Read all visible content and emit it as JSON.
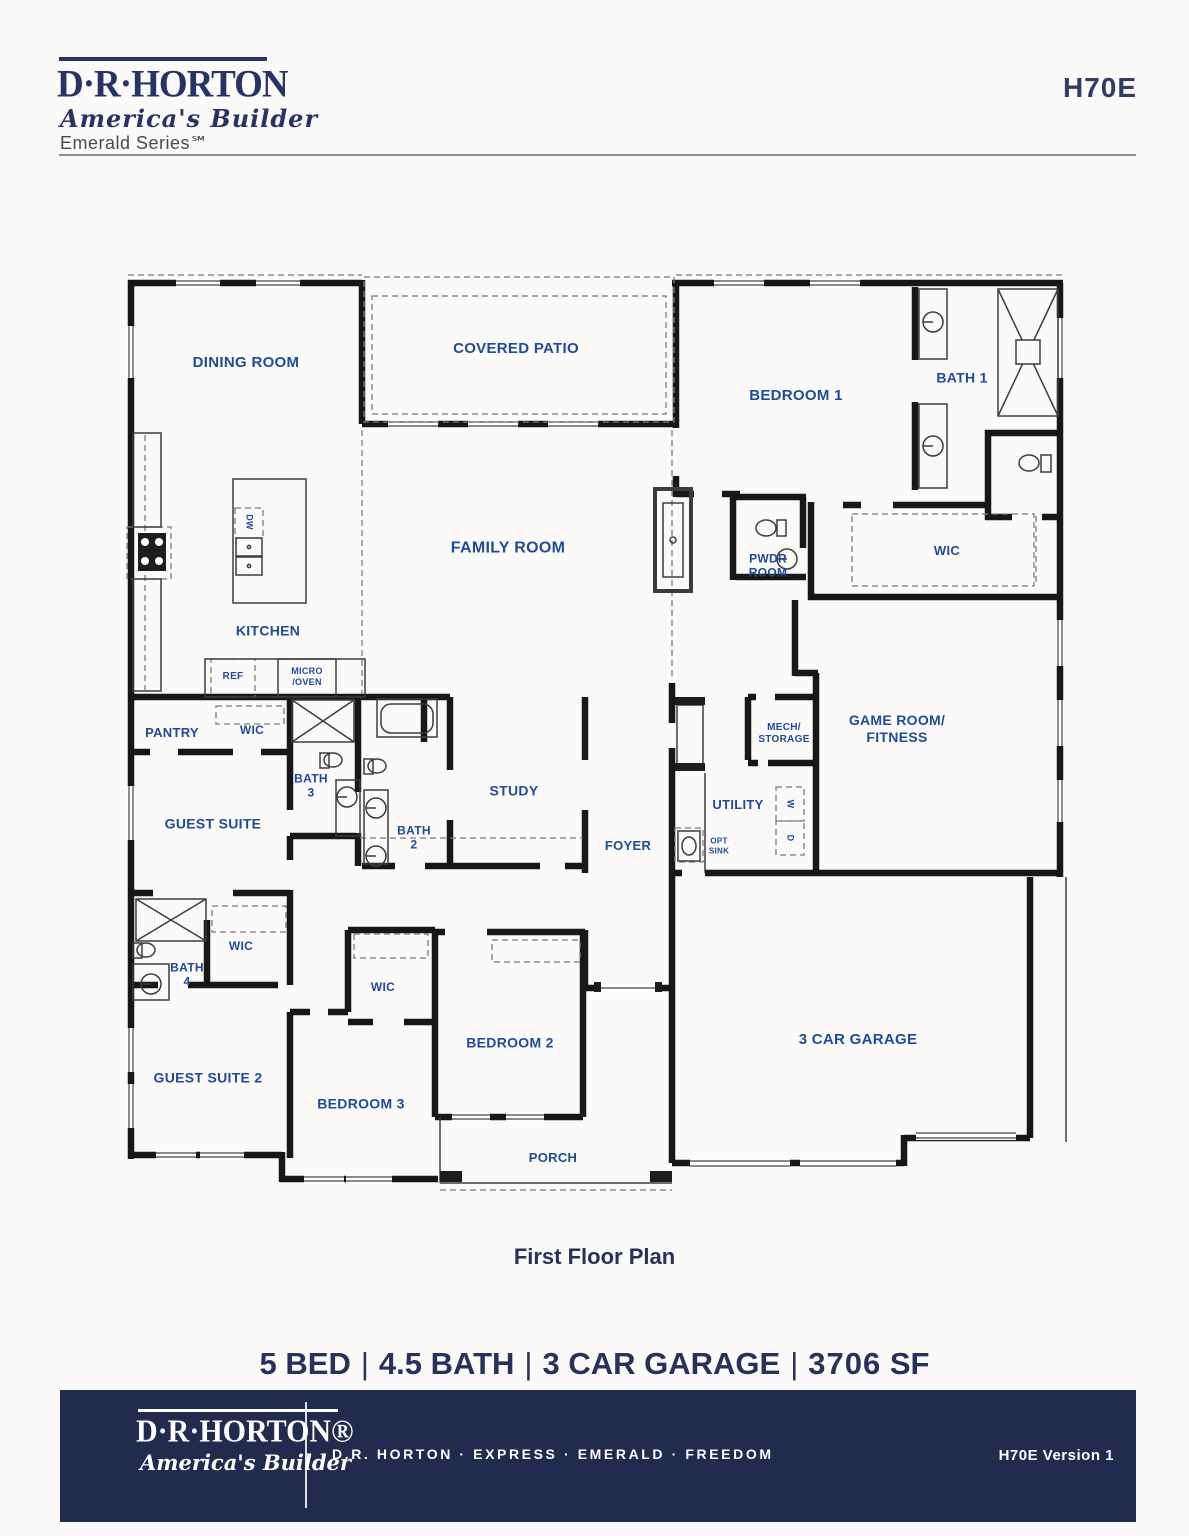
{
  "header": {
    "logo_name": "D·R·HORTON",
    "logo_tagline": "America's Builder",
    "logo_series": "Emerald Series℠",
    "plan_code": "H70E"
  },
  "floorplan": {
    "caption": "First Floor Plan",
    "rooms": [
      {
        "id": "dining-room",
        "label": "DINING ROOM",
        "x": 246,
        "y": 363,
        "fs": 15
      },
      {
        "id": "covered-patio",
        "label": "COVERED PATIO",
        "x": 516,
        "y": 349,
        "fs": 15
      },
      {
        "id": "bedroom-1",
        "label": "BEDROOM 1",
        "x": 796,
        "y": 396,
        "fs": 15
      },
      {
        "id": "bath-1",
        "label": "BATH 1",
        "x": 962,
        "y": 378,
        "fs": 14
      },
      {
        "id": "family-room",
        "label": "FAMILY ROOM",
        "x": 508,
        "y": 548,
        "fs": 16
      },
      {
        "id": "pwdr-room",
        "label": "PWDR\nROOM",
        "x": 768,
        "y": 566,
        "fs": 12
      },
      {
        "id": "wic-bedroom-1",
        "label": "WIC",
        "x": 947,
        "y": 551,
        "fs": 13
      },
      {
        "id": "kitchen",
        "label": "KITCHEN",
        "x": 268,
        "y": 631,
        "fs": 14
      },
      {
        "id": "dishwasher",
        "label": "DW",
        "x": 249,
        "y": 522,
        "fs": 9,
        "rot": 90
      },
      {
        "id": "refrigerator",
        "label": "REF",
        "x": 233,
        "y": 677,
        "fs": 10
      },
      {
        "id": "micro-oven",
        "label": "MICRO\n/OVEN",
        "x": 307,
        "y": 677,
        "fs": 9
      },
      {
        "id": "pantry",
        "label": "PANTRY",
        "x": 172,
        "y": 733,
        "fs": 13
      },
      {
        "id": "wic-guest-suite",
        "label": "WIC",
        "x": 252,
        "y": 730,
        "fs": 12
      },
      {
        "id": "bath-3",
        "label": "BATH\n3",
        "x": 311,
        "y": 786,
        "fs": 12
      },
      {
        "id": "bath-2",
        "label": "BATH\n2",
        "x": 414,
        "y": 838,
        "fs": 12
      },
      {
        "id": "study",
        "label": "STUDY",
        "x": 514,
        "y": 791,
        "fs": 14
      },
      {
        "id": "foyer",
        "label": "FOYER",
        "x": 628,
        "y": 846,
        "fs": 13
      },
      {
        "id": "guest-suite",
        "label": "GUEST SUITE",
        "x": 213,
        "y": 824,
        "fs": 14
      },
      {
        "id": "mech-storage",
        "label": "MECH/\nSTORAGE",
        "x": 784,
        "y": 734,
        "fs": 10
      },
      {
        "id": "game-room-fitness",
        "label": "GAME ROOM/\nFITNESS",
        "x": 897,
        "y": 729,
        "fs": 14
      },
      {
        "id": "utility",
        "label": "UTILITY",
        "x": 738,
        "y": 805,
        "fs": 13
      },
      {
        "id": "washer",
        "label": "W",
        "x": 790,
        "y": 804,
        "fs": 9,
        "rot": 90
      },
      {
        "id": "dryer",
        "label": "D",
        "x": 790,
        "y": 838,
        "fs": 9,
        "rot": 90
      },
      {
        "id": "opt-sink",
        "label": "OPT\nSINK",
        "x": 719,
        "y": 846,
        "fs": 8
      },
      {
        "id": "bath-4",
        "label": "BATH\n4",
        "x": 187,
        "y": 975,
        "fs": 12
      },
      {
        "id": "wic-guest-suite-2",
        "label": "WIC",
        "x": 241,
        "y": 946,
        "fs": 12
      },
      {
        "id": "guest-suite-2",
        "label": "GUEST SUITE 2",
        "x": 208,
        "y": 1078,
        "fs": 14
      },
      {
        "id": "wic-bedroom-3",
        "label": "WIC",
        "x": 383,
        "y": 987,
        "fs": 12
      },
      {
        "id": "bedroom-3",
        "label": "BEDROOM 3",
        "x": 361,
        "y": 1104,
        "fs": 14
      },
      {
        "id": "bedroom-2",
        "label": "BEDROOM 2",
        "x": 510,
        "y": 1043,
        "fs": 14
      },
      {
        "id": "porch",
        "label": "PORCH",
        "x": 553,
        "y": 1158,
        "fs": 13
      },
      {
        "id": "garage",
        "label": "3 CAR GARAGE",
        "x": 858,
        "y": 1040,
        "fs": 15
      }
    ]
  },
  "specs": {
    "bed": "5 BED",
    "bath": "4.5 BATH",
    "garage": "3 CAR GARAGE",
    "sqft_value": "3706",
    "sqft_unit": "SF",
    "separator": "|"
  },
  "footer": {
    "logo_name": "D·R·HORTON®",
    "logo_tagline": "America's Builder",
    "brands": "D.R. HORTON · EXPRESS · EMERALD · FREEDOM",
    "version": "H70E Version 1"
  },
  "colors": {
    "label_blue": "#1d4b9b",
    "brand_navy": "#263366",
    "footer_bg": "#222b4e"
  }
}
